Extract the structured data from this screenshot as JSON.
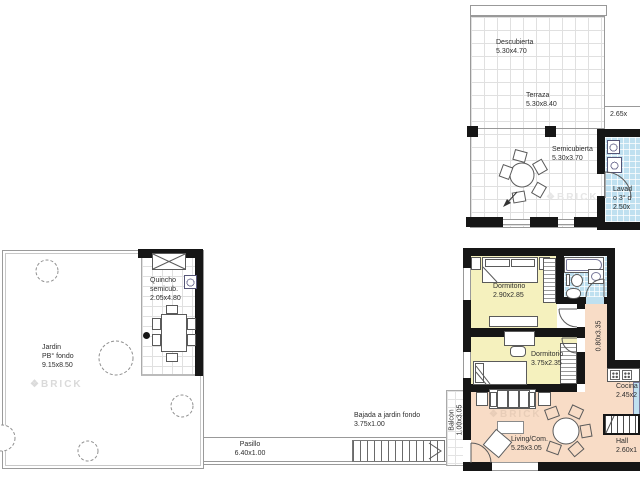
{
  "watermark": {
    "icon": "❖",
    "text": "BRICK"
  },
  "colors": {
    "wall": "#161616",
    "bedroom_floor": "#F5F1BE",
    "wet_area_floor": "#BFE0F0",
    "living_floor": "#F8DCC6",
    "tile_line": "#E0E0E0",
    "outline": "#8F8F8F",
    "label_text": "#2E2E2E",
    "watermark_gray": "#DADADA"
  },
  "terrace_block": {
    "descubierta": {
      "name": "Descubierta",
      "dim": "5.30x4.70"
    },
    "terraza": {
      "name": "Terraza",
      "dim": "5.30x8.40"
    },
    "semicubierta": {
      "name": "Semicubierta",
      "dim": "5.30x3.70"
    },
    "right_dim": "2.65x",
    "lavadero": {
      "line1": "Lavad",
      "line2": "o 3° d",
      "line3": "2.50x"
    }
  },
  "garden_block": {
    "jardin": {
      "line1": "Jardin",
      "line2": "PB° fondo",
      "line3": "9.15x8.50"
    },
    "quincho": {
      "line1": "Quincho",
      "line2": "semicub.",
      "line3": "2.05x4.80"
    }
  },
  "circulation": {
    "pasillo": {
      "name": "Pasillo",
      "dim": "6.40x1.00"
    },
    "bajada": {
      "name": "Bajada a jardin fondo",
      "dim": "3.75x1.00"
    },
    "balcon": {
      "name": "Balcon",
      "dim": "1.00x3.05"
    },
    "internal_hall_dim": "0.80x3.35"
  },
  "apartment": {
    "dormitorio1": {
      "name": "Dormitorio",
      "dim": "2.90x2.85"
    },
    "dormitorio2": {
      "name": "Dormitorio",
      "dim": "3.75x2.35"
    },
    "cocina": {
      "name": "Cocina",
      "dim": "2.45x2"
    },
    "hall": {
      "name": "Hall",
      "dim": "2.60x1"
    },
    "living": {
      "name": "Living/Com.",
      "dim": "5.25x3.05"
    }
  }
}
